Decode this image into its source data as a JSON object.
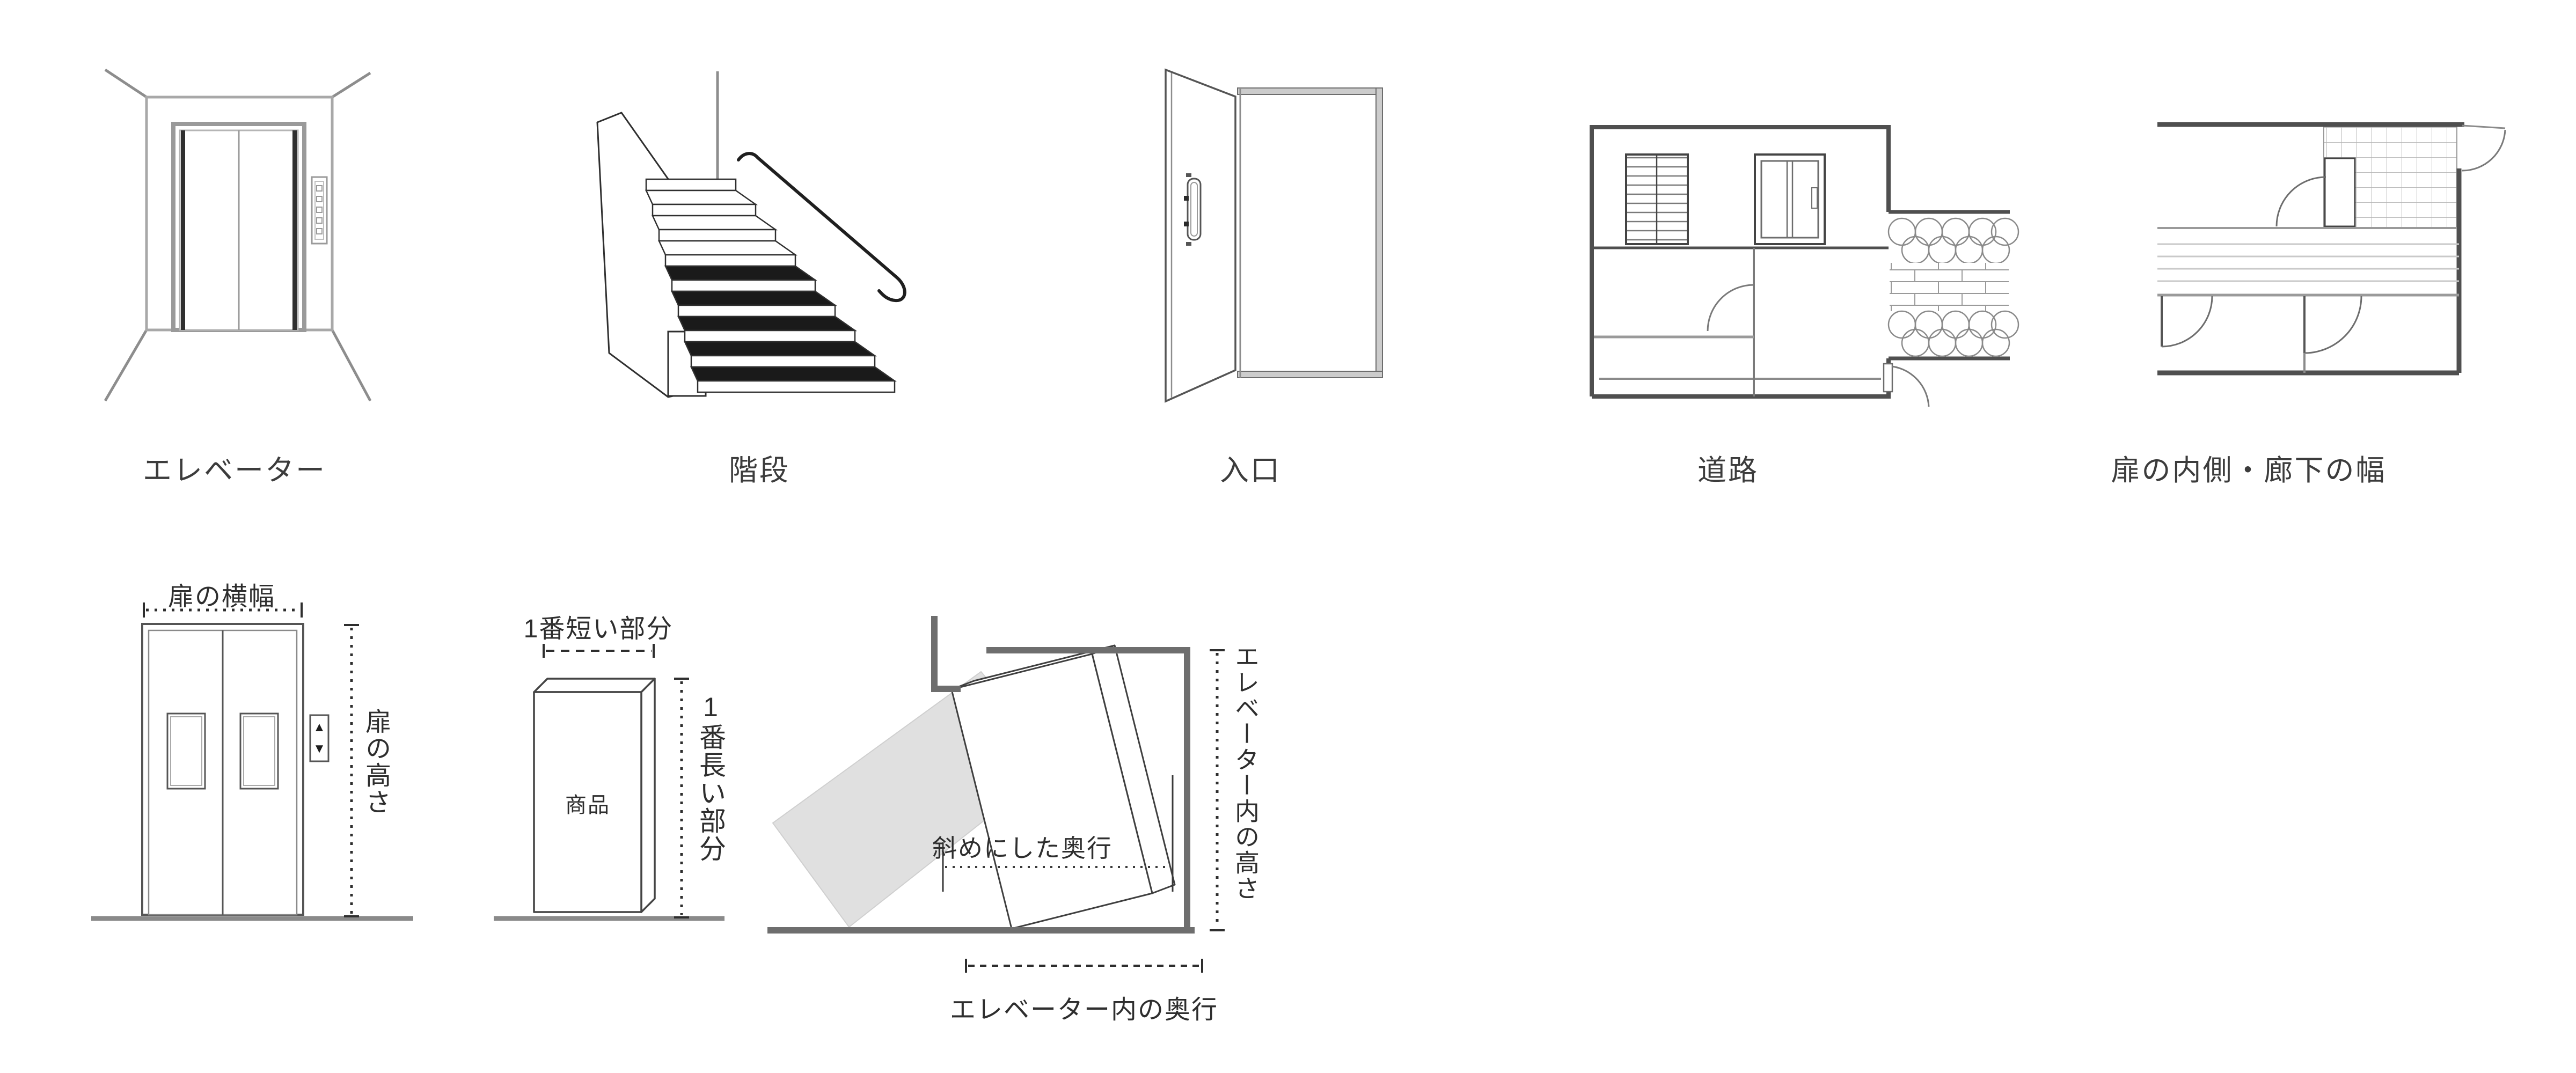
{
  "colors": {
    "line_dark": "#2e2e2e",
    "line_gray": "#9a9a9a",
    "wall_gray": "#6e6e6e",
    "ghost_fill": "#e0e0e0",
    "background": "#ffffff"
  },
  "top_figures": {
    "elevator": {
      "caption": "エレベーター"
    },
    "stairs": {
      "caption": "階段"
    },
    "entrance": {
      "caption": "入口"
    },
    "road": {
      "caption": "道路"
    },
    "hallway": {
      "caption": "扉の内側・廊下の幅"
    }
  },
  "door_size_diagram": {
    "width_label": "扉の横幅",
    "height_label": "扉の高さ",
    "up_icon": "▲",
    "down_icon": "▼"
  },
  "product_size_diagram": {
    "shortest_label": "1番短い部分",
    "longest_label": "1番長い部分",
    "product_label": "商品"
  },
  "elevator_interior_diagram": {
    "diagonal_depth_label": "斜めにした奥行",
    "inner_height_label": "エレベーター内の高さ",
    "inner_depth_label": "エレベーター内の奥行"
  }
}
